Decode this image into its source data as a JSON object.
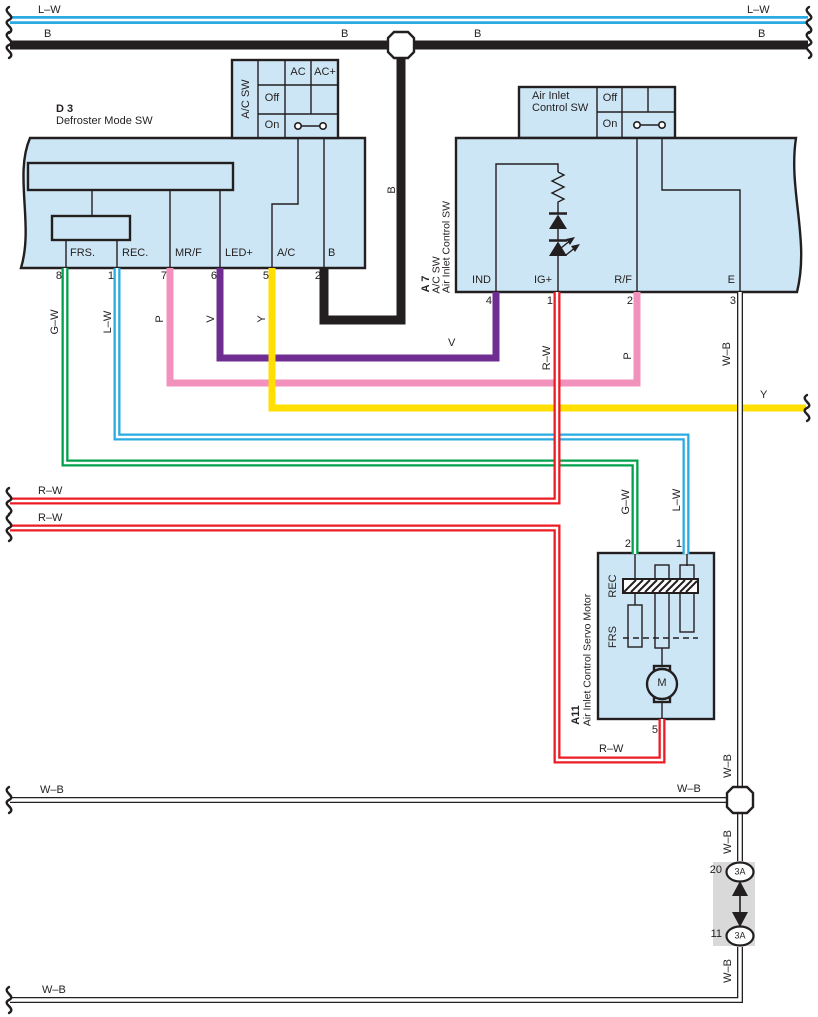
{
  "colors": {
    "component_fill": "#CDE6F5",
    "outline": "#231F20",
    "wire_green": "#00A14B",
    "wire_cyan": "#29ABE2",
    "wire_pink": "#F391BD",
    "wire_violet": "#6F2C91",
    "wire_yellow": "#FFDE00",
    "wire_red": "#EC1C24",
    "wire_black": "#231F20",
    "junction_gray": "#D9D9D9"
  },
  "wires": {
    "lw_battery": {
      "label": "L–W"
    },
    "b_ground": {
      "label": "B"
    },
    "gw": {
      "label": "G–W"
    },
    "lw": {
      "label": "L–W"
    },
    "p": {
      "label": "P"
    },
    "v": {
      "label": "V"
    },
    "y": {
      "label": "Y"
    },
    "rw": {
      "label": "R–W"
    },
    "wb": {
      "label": "W–B"
    }
  },
  "components": {
    "d3": {
      "code": "D 3",
      "name": "Defroster Mode SW",
      "terminals": [
        {
          "label": "FRS.",
          "pin": "8"
        },
        {
          "label": "REC.",
          "pin": "1"
        },
        {
          "label": "MR/F",
          "pin": "7"
        },
        {
          "label": "LED+",
          "pin": "6"
        },
        {
          "label": "A/C",
          "pin": "5"
        },
        {
          "label": "B",
          "pin": "2"
        }
      ]
    },
    "ac_sw": {
      "title": "A/C SW",
      "col_ac": "AC",
      "col_acplus": "AC+",
      "row_off": "Off",
      "row_on": "On"
    },
    "air_inlet_sw": {
      "title_line1": "Air Inlet",
      "title_line2": "Control SW",
      "row_off": "Off",
      "row_on": "On"
    },
    "a7": {
      "code": "A 7",
      "sub1": "A/C SW",
      "sub2": "Air Inlet Control SW",
      "terminals": [
        {
          "label": "IND",
          "pin": "4"
        },
        {
          "label": "IG+",
          "pin": "1"
        },
        {
          "label": "R/F",
          "pin": "2"
        },
        {
          "label": "E",
          "pin": "3"
        }
      ]
    },
    "a11": {
      "code": "A11",
      "name": "Air Inlet Control Servo Motor",
      "rec": "REC",
      "frs": "FRS",
      "motor": "M",
      "pins": {
        "p2": "2",
        "p1": "1",
        "p5": "5"
      }
    },
    "junction": {
      "pin_top": "20",
      "pin_bottom": "11",
      "amp_top": "3A",
      "amp_bottom": "3A"
    }
  }
}
